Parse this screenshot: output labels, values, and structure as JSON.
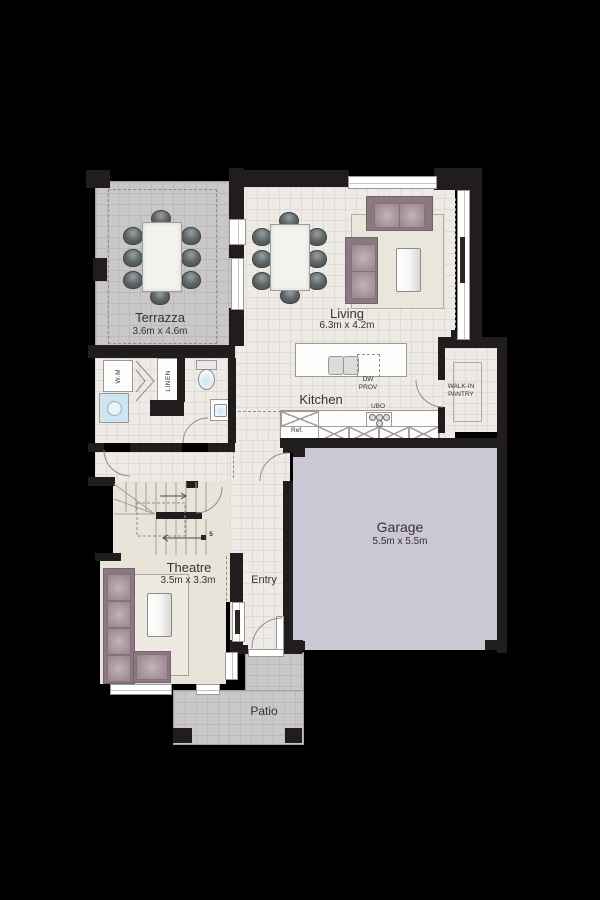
{
  "colors": {
    "background": "#000000",
    "wall": "#211d1e",
    "indoor_floor": "#eeebe7",
    "indoor_grid": "#dfdbd5",
    "outdoor_floor": "#c9c7c8",
    "outdoor_grid": "#bbb9b9",
    "carpet": "#e8e4da",
    "garage_floor": "#cbc7d4",
    "sofa": "#9d8a93",
    "sofa_dark": "#8b7881",
    "rug": "#e9e6dc",
    "chair": "#5b6264",
    "water": "#cfe5f1"
  },
  "rooms": {
    "terrazza": {
      "name": "Terrazza",
      "dims": "3.6m x 4.6m"
    },
    "living": {
      "name": "Living",
      "dims": "6.3m x 4.2m"
    },
    "kitchen": {
      "name": "Kitchen"
    },
    "pantry": {
      "name_line1": "WALK-IN",
      "name_line2": "PANTRY"
    },
    "garage": {
      "name": "Garage",
      "dims": "5.5m x 5.5m"
    },
    "theatre": {
      "name": "Theatre",
      "dims": "3.5m x 3.3m"
    },
    "entry": {
      "name": "Entry"
    },
    "patio": {
      "name": "Patio"
    }
  },
  "fixtures": {
    "washing_machine": "W.M",
    "linen": "LINEN",
    "dishwasher_line1": "DW",
    "dishwasher_line2": "PROV",
    "oven": "UBO",
    "fridge": "Ref.",
    "stair_riser_count": "5"
  }
}
